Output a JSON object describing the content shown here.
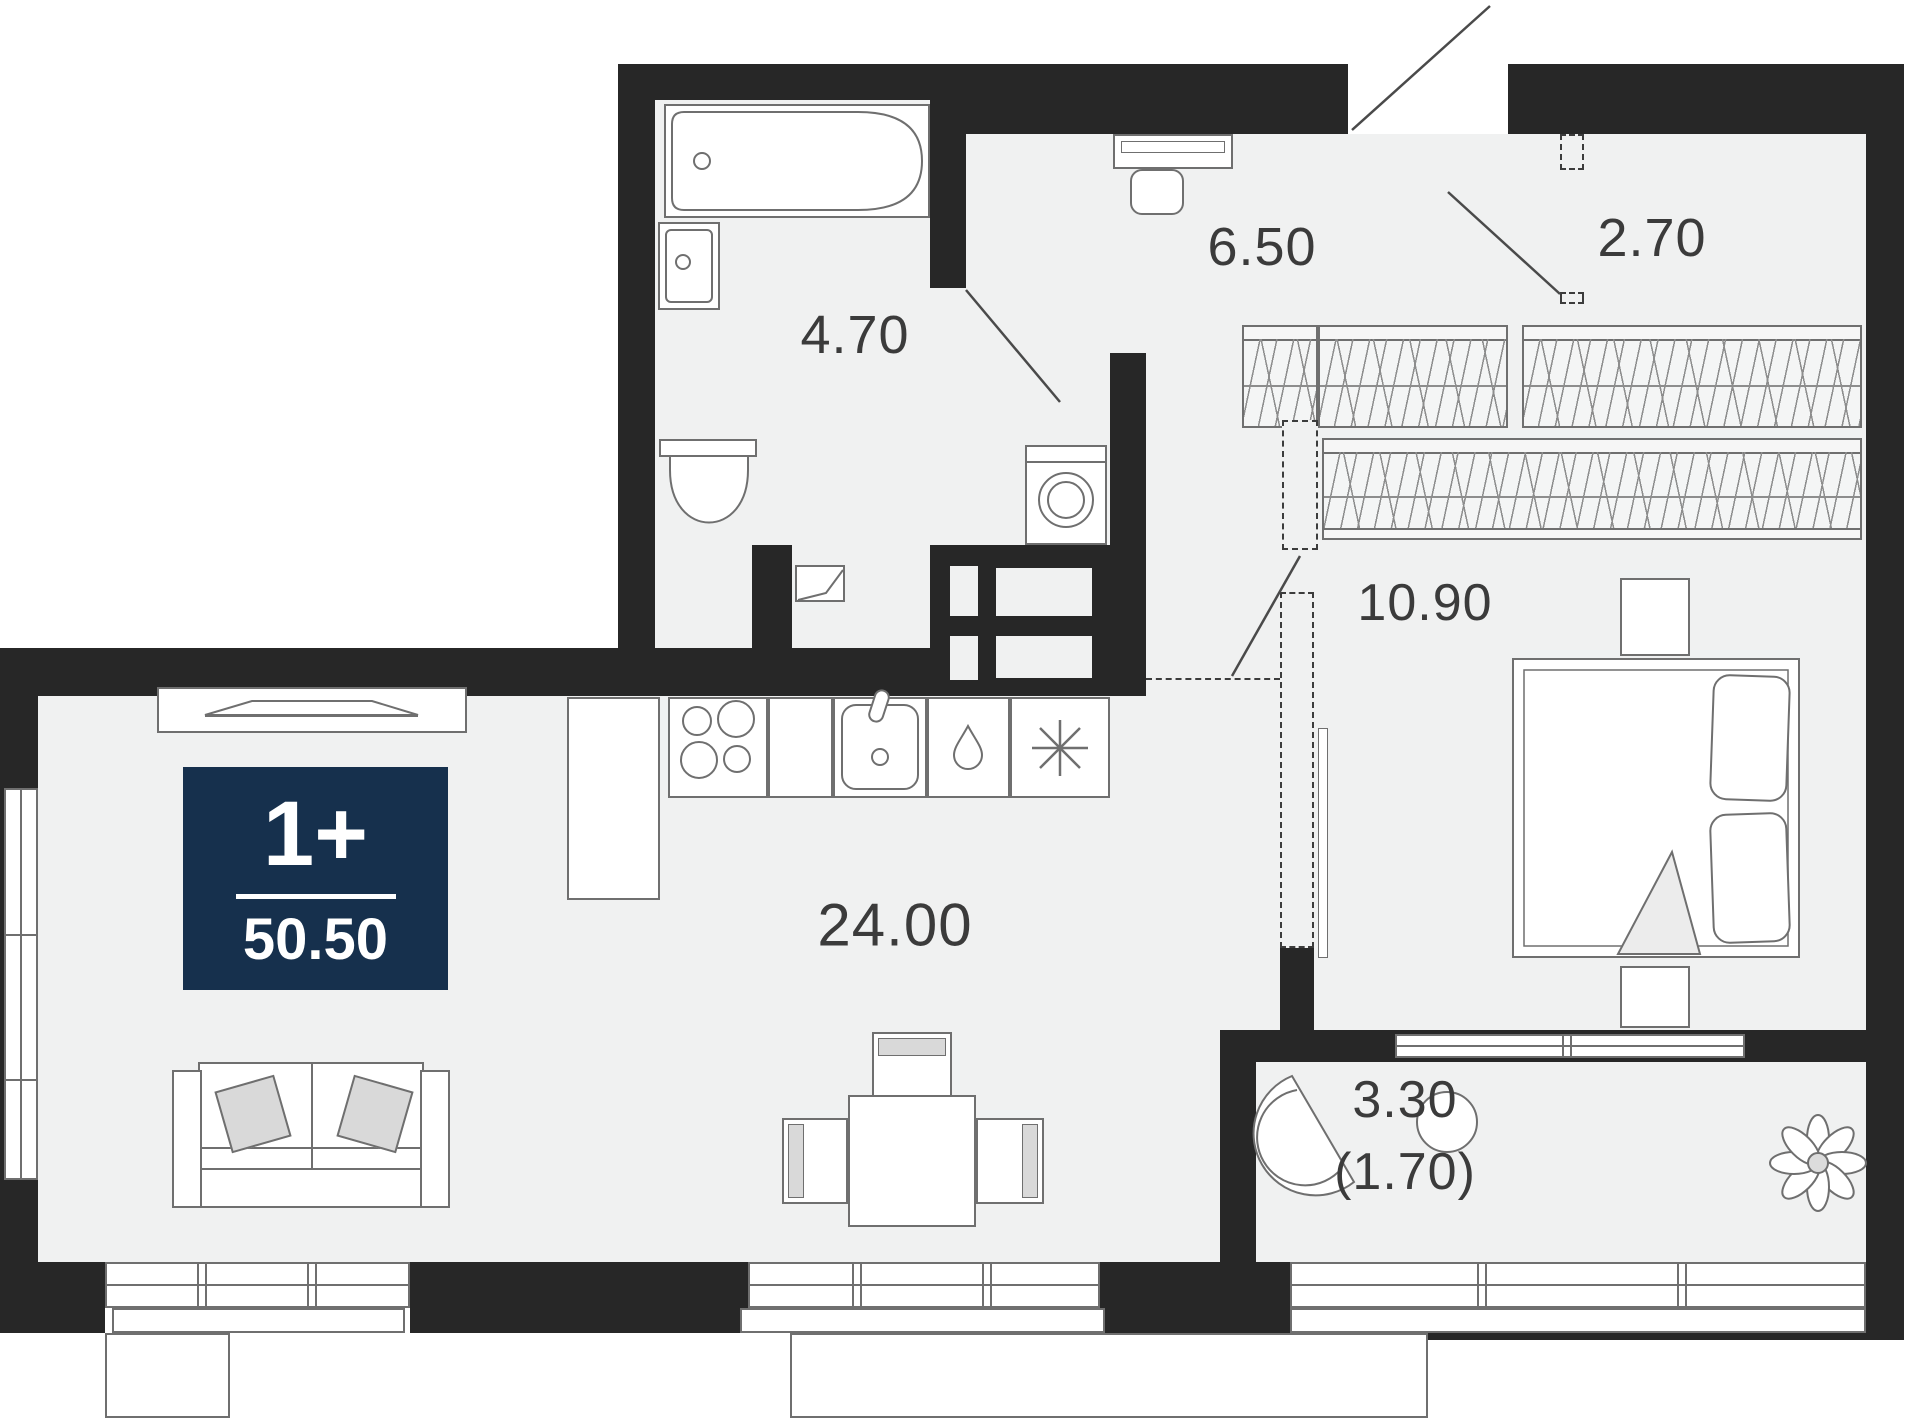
{
  "plan": {
    "badge": {
      "rooms_label": "1+",
      "area_total": "50.50"
    },
    "rooms": {
      "bathroom": {
        "area": "4.70"
      },
      "hallway": {
        "area": "6.50"
      },
      "closet": {
        "area": "2.70"
      },
      "bedroom": {
        "area": "10.90"
      },
      "living_kitchen": {
        "area": "24.00"
      },
      "balcony": {
        "area": "3.30",
        "area_coeff": "(1.70)"
      }
    },
    "colors": {
      "wall": "#272727",
      "floor": "#f0f1f1",
      "badge_bg": "#16304d",
      "furniture_stroke": "#6f6f6f",
      "label_text": "#3b3b3b"
    }
  }
}
